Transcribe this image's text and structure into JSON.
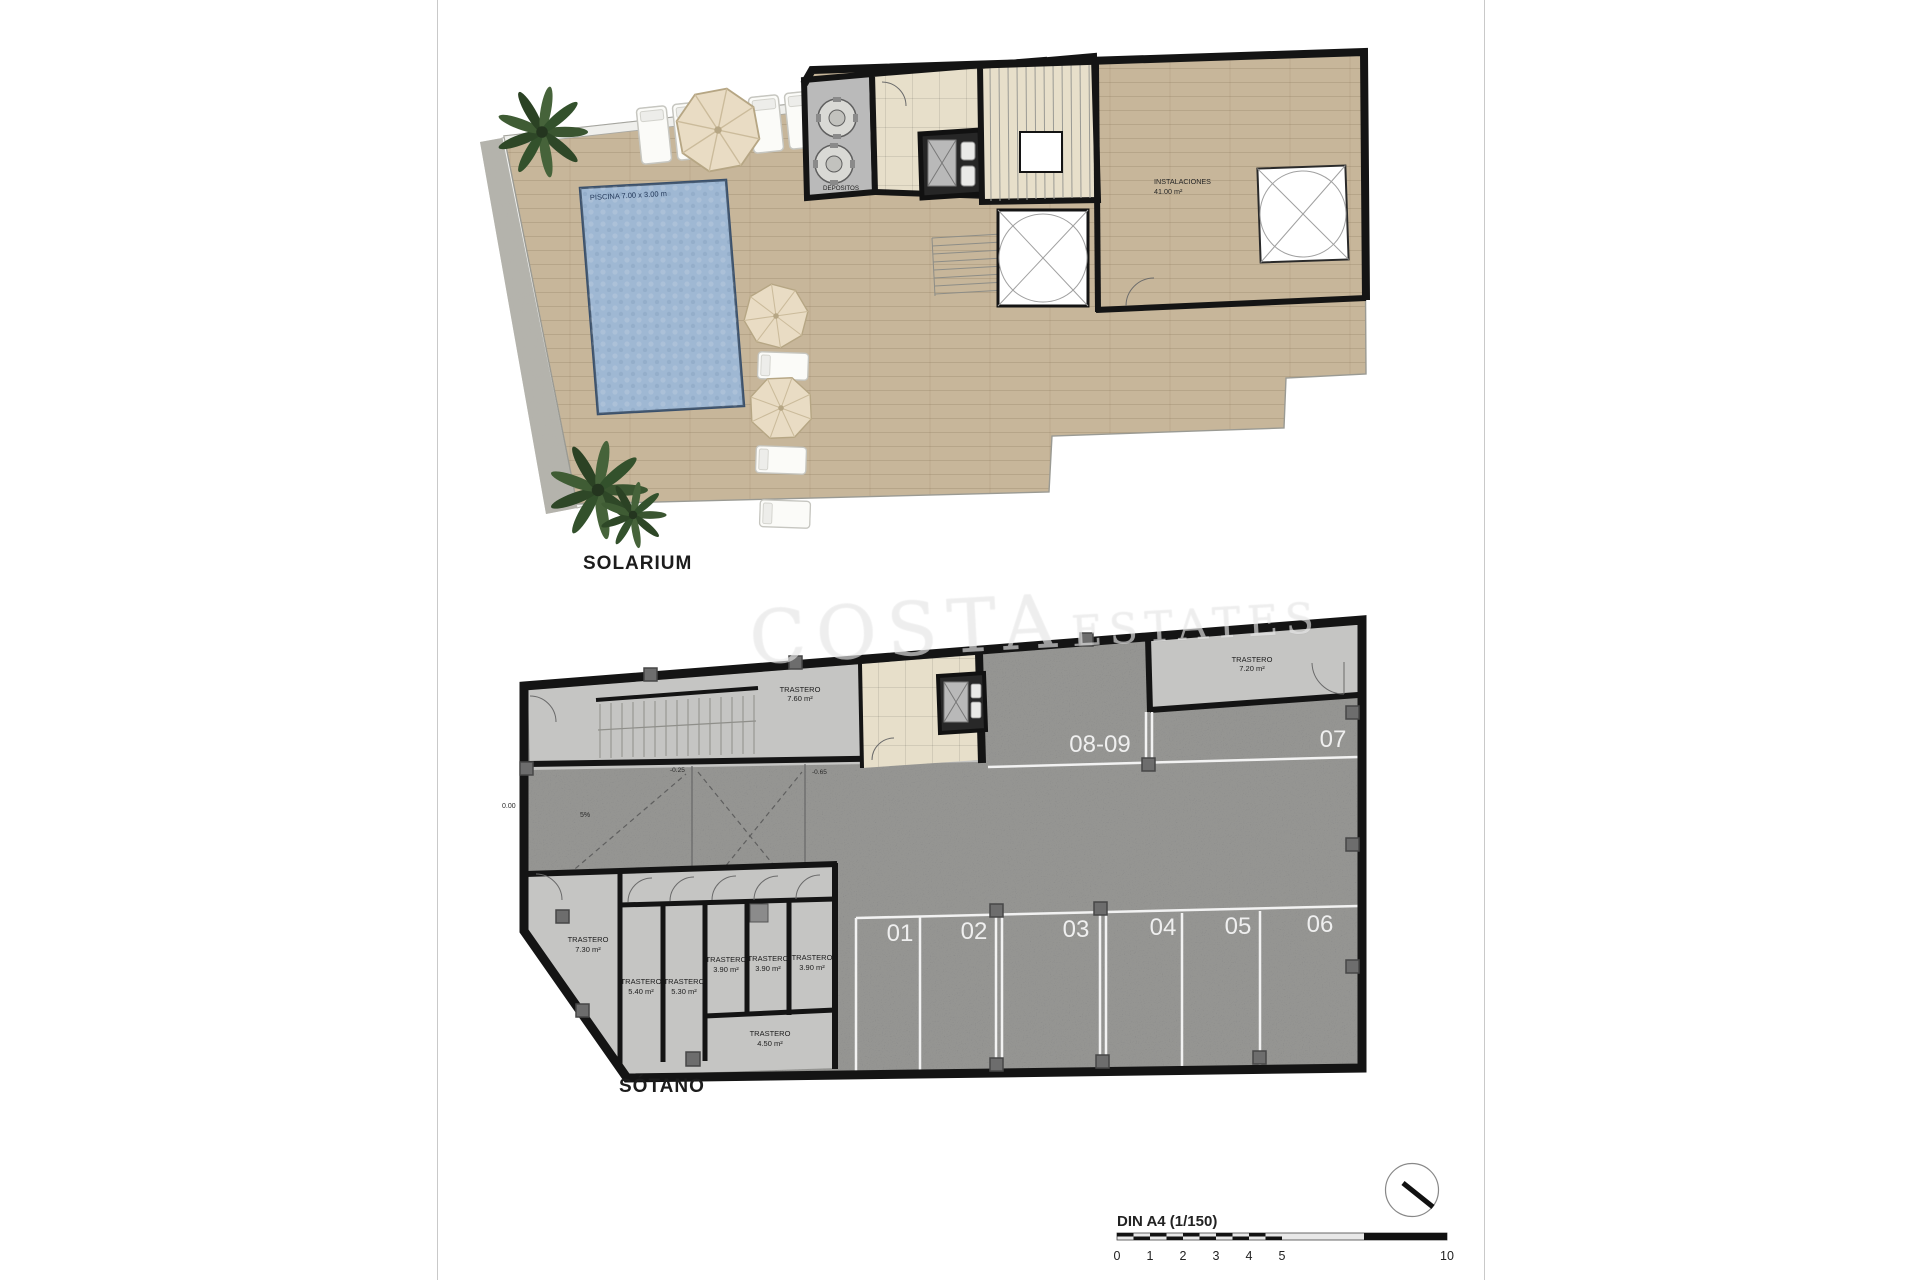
{
  "document": {
    "sheet_format": "DIN A4 (1/150)",
    "scale_ticks": [
      "0",
      "1",
      "2",
      "3",
      "4",
      "5",
      "10"
    ]
  },
  "watermark": {
    "part1": "COSTA",
    "part2": "ESTATES"
  },
  "solarium": {
    "title": "SOLARIUM",
    "pool_dim_label": "PISCINA 7.00 x 3.00 m",
    "pool_area_name": "PISCINA",
    "pool_area_value": "95.80 m²",
    "depositos_label": "DEPOSITOS",
    "instalaciones_name": "INSTALACIONES",
    "instalaciones_area": "41.00 m²"
  },
  "basement": {
    "title": "SÓTANO",
    "parking_row_top": [
      "08-09",
      "07"
    ],
    "parking_row_bottom": [
      "01",
      "02",
      "03",
      "04",
      "05",
      "06"
    ],
    "storages": [
      {
        "name": "TRASTERO",
        "area": "7.60 m²"
      },
      {
        "name": "TRASTERO",
        "area": "7.20 m²"
      },
      {
        "name": "TRASTERO",
        "area": "7.30 m²"
      },
      {
        "name": "TRASTERO",
        "area": "5.40 m²"
      },
      {
        "name": "TRASTERO",
        "area": "5.30 m²"
      },
      {
        "name": "TRASTERO",
        "area": "3.90 m²"
      },
      {
        "name": "TRASTERO",
        "area": "3.90 m²"
      },
      {
        "name": "TRASTERO",
        "area": "3.90 m²"
      },
      {
        "name": "TRASTERO",
        "area": "4.50 m²"
      }
    ],
    "levels": {
      "zero": "0.00",
      "slope": "5%",
      "l1": "-0.25",
      "l2": "-0.65"
    }
  },
  "colors": {
    "wall": "#141414",
    "asphalt": "#7d7d7d",
    "terrace": "#c7b69a",
    "pool": "#9db9d9",
    "light_room": "#c5c5c3",
    "beige_tile": "#e7dfca",
    "parking_line": "#f2f2f2"
  }
}
